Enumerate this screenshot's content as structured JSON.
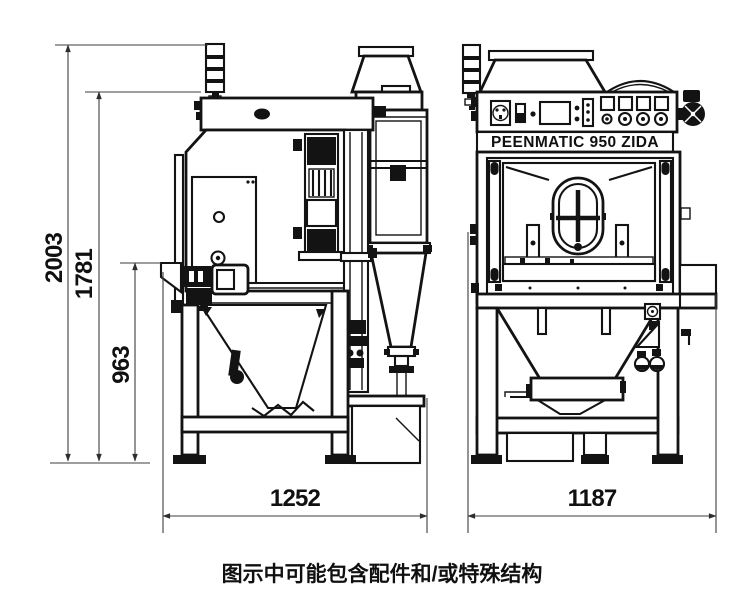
{
  "page": {
    "background": "#ffffff"
  },
  "drawing": {
    "brand_label": "PEENMATIC 950 ZIDA",
    "caption": "图示中可能包含配件和/或特殊结构",
    "line_color": "#131313",
    "dim_line_color": "#3d3d3d",
    "dimensions": {
      "overall_height": "2003",
      "body_height": "1781",
      "hopper_height": "963",
      "side_depth": "1252",
      "front_width": "1187"
    }
  }
}
